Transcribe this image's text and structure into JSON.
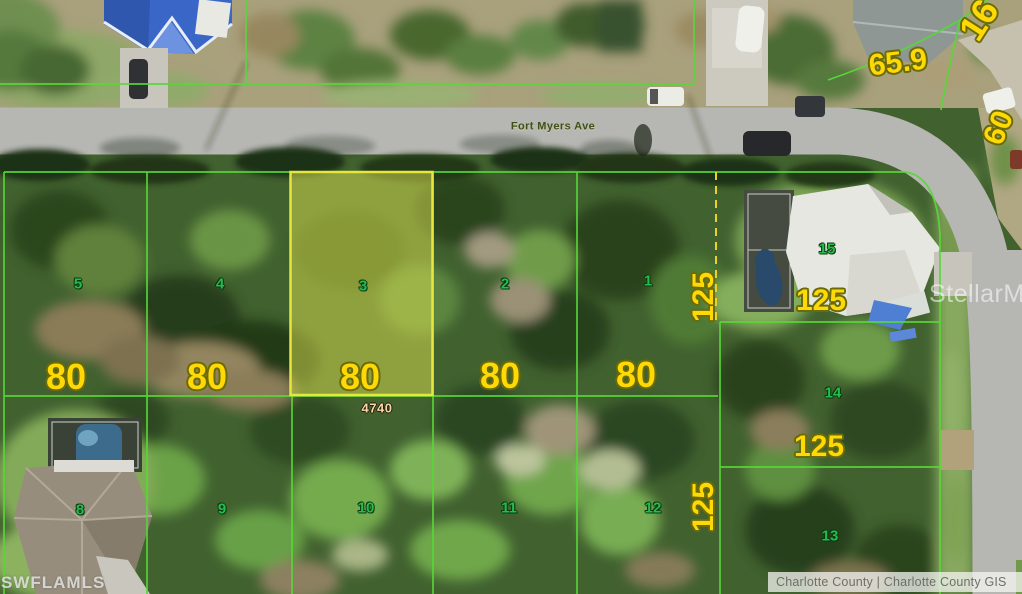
{
  "map": {
    "street_label": "Fort Myers Ave",
    "address_label": "4740",
    "watermark_left": "SWFLAMLS",
    "watermark_right": "StellarMLS",
    "attribution": "Charlotte County  |  Charlotte County GIS",
    "highlighted_lot": "3",
    "colors": {
      "parcel_line": "#58d838",
      "dashed_line": "#ead22a",
      "highlight_fill": "rgba(222,226,80,0.5)",
      "highlight_stroke": "#e6e63c",
      "lot_number": "#25bb4d",
      "dimension": "#ffd906"
    },
    "lots": [
      {
        "n": "5",
        "x": 78,
        "y": 284
      },
      {
        "n": "4",
        "x": 220,
        "y": 284
      },
      {
        "n": "3",
        "x": 363,
        "y": 286
      },
      {
        "n": "2",
        "x": 505,
        "y": 284
      },
      {
        "n": "1",
        "x": 648,
        "y": 281
      },
      {
        "n": "15",
        "x": 827,
        "y": 249
      },
      {
        "n": "14",
        "x": 833,
        "y": 393
      },
      {
        "n": "13",
        "x": 830,
        "y": 536
      },
      {
        "n": "8",
        "x": 80,
        "y": 510
      },
      {
        "n": "9",
        "x": 222,
        "y": 509
      },
      {
        "n": "10",
        "x": 366,
        "y": 508
      },
      {
        "n": "11",
        "x": 509,
        "y": 508
      },
      {
        "n": "12",
        "x": 653,
        "y": 508
      }
    ],
    "dimensions": [
      {
        "text": "80",
        "x": 66,
        "y": 377,
        "size": 36,
        "rot": 0
      },
      {
        "text": "80",
        "x": 207,
        "y": 377,
        "size": 36,
        "rot": 0
      },
      {
        "text": "80",
        "x": 360,
        "y": 377,
        "size": 36,
        "rot": 0
      },
      {
        "text": "80",
        "x": 500,
        "y": 376,
        "size": 36,
        "rot": 0
      },
      {
        "text": "80",
        "x": 636,
        "y": 375,
        "size": 36,
        "rot": 0
      },
      {
        "text": "125",
        "x": 704,
        "y": 297,
        "size": 30,
        "rot": -90
      },
      {
        "text": "125",
        "x": 704,
        "y": 507,
        "size": 30,
        "rot": -90
      },
      {
        "text": "125",
        "x": 821,
        "y": 301,
        "size": 30,
        "rot": 0
      },
      {
        "text": "125",
        "x": 819,
        "y": 447,
        "size": 30,
        "rot": 0
      },
      {
        "text": "65.9",
        "x": 898,
        "y": 63,
        "size": 30,
        "rot": -7
      },
      {
        "text": "16",
        "x": 979,
        "y": 20,
        "size": 36,
        "rot": -57
      },
      {
        "text": "60",
        "x": 999,
        "y": 128,
        "size": 30,
        "rot": -68
      }
    ]
  }
}
